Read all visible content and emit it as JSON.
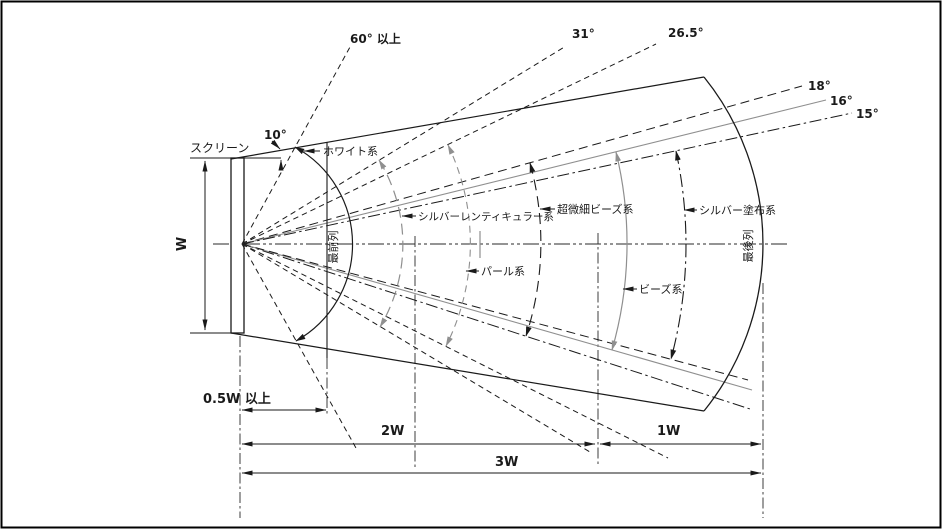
{
  "figure": {
    "description_labels": {
      "screen": "スクリーン",
      "screen_width": "W",
      "front_row": "最前列",
      "back_row": "最後列"
    },
    "angles": {
      "a10": "10°",
      "a60": "60° 以上",
      "a31": "31°",
      "a26_5": "26.5°",
      "a18": "18°",
      "a16": "16°",
      "a15": "15°"
    },
    "screen_types": [
      {
        "name": "ホワイト系",
        "half_viewing_angle": "60° 以上"
      },
      {
        "name": "シルバーレンティキュラー系",
        "half_viewing_angle": "31°"
      },
      {
        "name": "パール系",
        "half_viewing_angle": "26.5°"
      },
      {
        "name": "超微細ビーズ系",
        "half_viewing_angle": "18°"
      },
      {
        "name": "ビーズ系",
        "half_viewing_angle": "16°"
      },
      {
        "name": "シルバー塗布系",
        "half_viewing_angle": "15°"
      }
    ],
    "distances": {
      "front_min": "0.5W 以上",
      "mark_2w": "2W",
      "mark_1w": "1W",
      "mark_3w": "3W"
    },
    "colors": {
      "line": "#1a1a1a",
      "gray": "#8f8f8f",
      "background": "#ffffff"
    }
  },
  "labels": {
    "screen": "スクリーン",
    "w": "W",
    "angle_10": "10°",
    "angle_60": "60° 以上",
    "angle_31": "31°",
    "angle_26_5": "26.5°",
    "angle_18": "18°",
    "angle_16": "16°",
    "angle_15": "15°",
    "type_white": "ホワイト系",
    "type_silver_lenticular": "シルバーレンティキュラー系",
    "type_ultra_fine_beads": "超微細ビーズ系",
    "type_silver_coated": "シルバー塗布系",
    "type_pearl": "パール系",
    "type_beads": "ビーズ系",
    "front_row": "最前列",
    "back_row": "最後列",
    "dist_front": "0.5W 以上",
    "dist_2w": "2W",
    "dist_1w": "1W",
    "dist_3w": "3W"
  }
}
